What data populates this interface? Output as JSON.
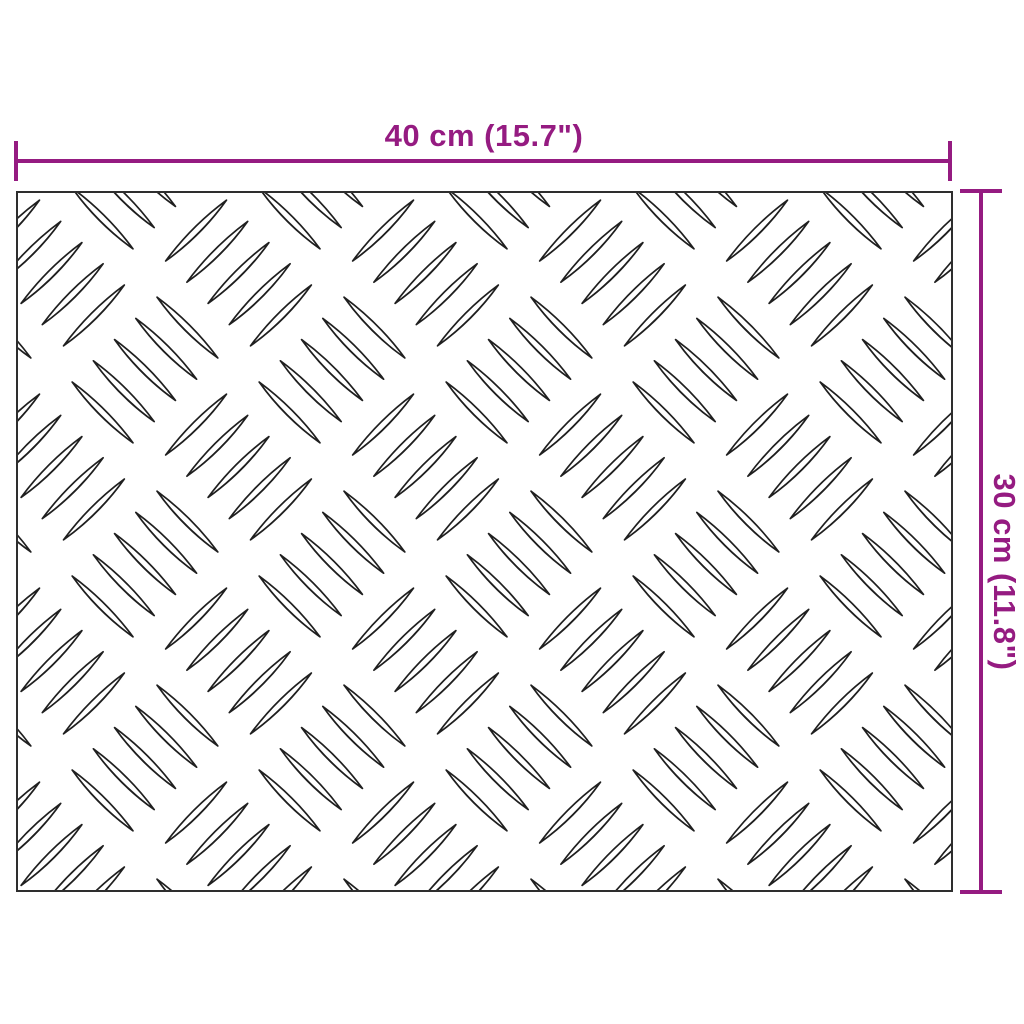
{
  "diagram": {
    "type": "product-dimension-drawing",
    "subject": "checker-plate-sheet",
    "dimensions": {
      "width": {
        "label": "40 cm (15.7\")",
        "value_cm": 40,
        "value_inch": 15.7
      },
      "height": {
        "label": "30 cm (11.8\")",
        "value_cm": 30,
        "value_inch": 11.8
      }
    },
    "colors": {
      "dimension_accent": "#951B81",
      "plate_border": "#2E2E2E",
      "pattern_stroke": "#1F1F1F",
      "background": "#FFFFFF"
    },
    "pattern": {
      "name": "5-bar-checker-plate",
      "lenses_per_group": 5,
      "lens_length": 86,
      "lens_width": 13,
      "lens_spacing": 30,
      "col_spacing": 187,
      "row_spacing": 97
    }
  }
}
